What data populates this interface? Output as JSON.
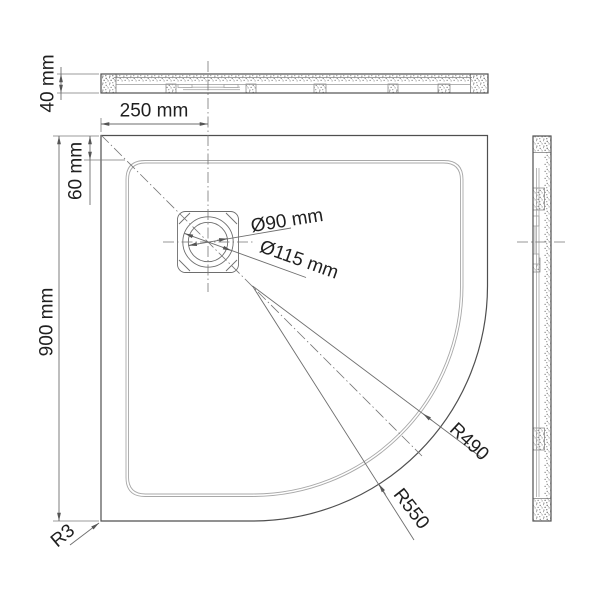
{
  "drawing": {
    "dimensions": {
      "tray_height": "40 mm",
      "drain_center_from_left": "250 mm",
      "rim_width": "60 mm",
      "tray_width": "900 mm",
      "corner_radius": "R3",
      "drain_diameter_inner": "Ø90 mm",
      "drain_diameter_outer": "Ø115 mm",
      "inner_corner_arc_radius": "R490",
      "outer_corner_arc_radius": "R550"
    },
    "colors": {
      "background": "#ffffff",
      "main_line": "#4f4f4f",
      "thin_line": "#6e6e6e",
      "light_line": "#a8a8a8",
      "centerline": "#767676",
      "stipple": "#707070",
      "text": "#1f1f1f"
    }
  }
}
